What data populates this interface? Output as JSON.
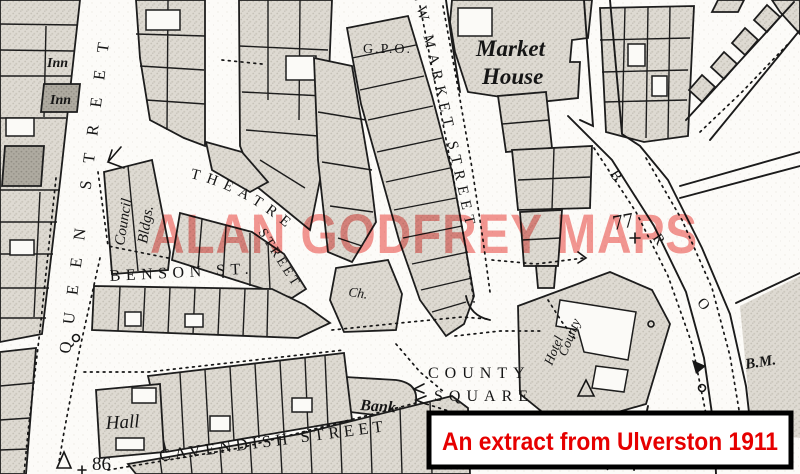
{
  "map": {
    "watermark": "ALAN GODFREY MAPS",
    "caption": "An extract from Ulverston 1911",
    "streets": {
      "queen": "QUEEN STREET",
      "new_market": "NEW MARKET STREET",
      "theatre_word1": "THEATRE",
      "theatre_word2": "STREET",
      "benson": "BENSON ST.",
      "cavendish": "CAVENDISH STREET",
      "county_square_word1": "COUNTY",
      "county_square_word2": "SQUARE",
      "right_street_letters": [
        "B",
        "R",
        "O"
      ]
    },
    "labels": {
      "market_house_word1": "Market",
      "market_house_word2": "House",
      "gpo": "G.P.O.",
      "council_word1": "Council",
      "council_word2": "Bldgs.",
      "church": "Ch.",
      "bank": "Bank",
      "hall": "Hall",
      "inn_upper": "Inn",
      "inn_lower": "Inn",
      "county_hotel_word1": "County",
      "county_hotel_word2": "Hotel"
    },
    "markers": {
      "plot_77": "77",
      "plot_86": "86",
      "bench_mark": "B.M."
    },
    "colors": {
      "watermark_red": "#f2807c",
      "caption_red": "#e60000",
      "caption_border": "#000000",
      "map_line": "#1d1d1d",
      "building_fill": "#dedad2",
      "paper": "#fcfbf8"
    }
  }
}
